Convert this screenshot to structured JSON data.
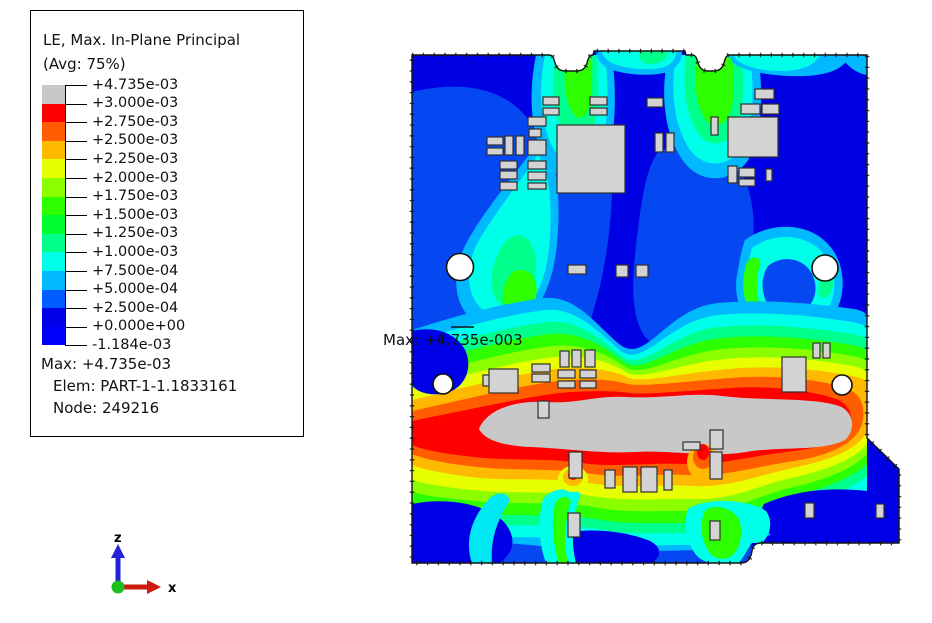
{
  "legend": {
    "title": "LE, Max. In-Plane Principal",
    "subtitle": "(Avg: 75%)",
    "bands": [
      {
        "color": "#C8C8C8",
        "label": "+4.735e-03"
      },
      {
        "color": "#FF0000",
        "label": "+3.000e-03"
      },
      {
        "color": "#FF5D00",
        "label": "+2.750e-03"
      },
      {
        "color": "#FFB900",
        "label": "+2.500e-03"
      },
      {
        "color": "#E8FF00",
        "label": "+2.250e-03"
      },
      {
        "color": "#8BFF00",
        "label": "+2.000e-03"
      },
      {
        "color": "#2EFF00",
        "label": "+1.750e-03"
      },
      {
        "color": "#00FF2E",
        "label": "+1.500e-03"
      },
      {
        "color": "#00FF8B",
        "label": "+1.250e-03"
      },
      {
        "color": "#00FFE8",
        "label": "+1.000e-03"
      },
      {
        "color": "#00B9FF",
        "label": "+7.500e-04"
      },
      {
        "color": "#005DFF",
        "label": "+5.000e-04"
      },
      {
        "color": "#0000E8",
        "label": "+2.500e-04"
      },
      {
        "color": "#0000FF",
        "label": "+0.000e+00"
      }
    ],
    "min_label": "-1.184e-03",
    "max_line": "Max: +4.735e-03",
    "elem_line": "Elem: PART-1-1.1833161",
    "node_line": "Node: 249216"
  },
  "annotation": {
    "max_label": "Max: +4.735e-003"
  },
  "triad": {
    "vertical_axis": "z",
    "horizontal_axis": "x",
    "z_color": "#2222D6",
    "x_color": "#CC1A0E",
    "origin_color": "#1FBE1F"
  },
  "plot": {
    "component_fill": "#D3D3D3",
    "component_stroke": "#2F2F2F",
    "components": [
      [
        543,
        97,
        16,
        8
      ],
      [
        543,
        108,
        16,
        7
      ],
      [
        590,
        97,
        17,
        8
      ],
      [
        590,
        108,
        17,
        7
      ],
      [
        647,
        98,
        16,
        9
      ],
      [
        755,
        89,
        19,
        10
      ],
      [
        741,
        104,
        19,
        10
      ],
      [
        762,
        104,
        17,
        10
      ],
      [
        711,
        117,
        7,
        18
      ],
      [
        487,
        137,
        16,
        8
      ],
      [
        487,
        148,
        16,
        7
      ],
      [
        505,
        136,
        8,
        19
      ],
      [
        516,
        136,
        8,
        19
      ],
      [
        528,
        117,
        18,
        9
      ],
      [
        529,
        129,
        12,
        8
      ],
      [
        528,
        140,
        18,
        15
      ],
      [
        557,
        125,
        68,
        68
      ],
      [
        500,
        161,
        17,
        8
      ],
      [
        500,
        171,
        17,
        8
      ],
      [
        500,
        182,
        17,
        8
      ],
      [
        528,
        161,
        18,
        8
      ],
      [
        528,
        172,
        18,
        8
      ],
      [
        528,
        183,
        18,
        6
      ],
      [
        728,
        117,
        50,
        40
      ],
      [
        655,
        133,
        8,
        19
      ],
      [
        666,
        133,
        8,
        19
      ],
      [
        728,
        166,
        9,
        17
      ],
      [
        739,
        168,
        16,
        9
      ],
      [
        739,
        179,
        16,
        7
      ],
      [
        766,
        169,
        6,
        12
      ],
      [
        568,
        265,
        18,
        9
      ],
      [
        616,
        265,
        12,
        12
      ],
      [
        636,
        265,
        12,
        12
      ],
      [
        483,
        375,
        7,
        11
      ],
      [
        489,
        369,
        29,
        24
      ],
      [
        532,
        364,
        18,
        8
      ],
      [
        532,
        374,
        18,
        8
      ],
      [
        560,
        351,
        9,
        16
      ],
      [
        572,
        350,
        9,
        17
      ],
      [
        585,
        350,
        10,
        17
      ],
      [
        558,
        370,
        17,
        8
      ],
      [
        580,
        370,
        16,
        8
      ],
      [
        558,
        381,
        17,
        7
      ],
      [
        580,
        381,
        16,
        7
      ],
      [
        538,
        401,
        11,
        17
      ],
      [
        569,
        452,
        13,
        26
      ],
      [
        605,
        470,
        10,
        18
      ],
      [
        623,
        467,
        14,
        25
      ],
      [
        641,
        467,
        16,
        25
      ],
      [
        664,
        470,
        8,
        20
      ],
      [
        683,
        442,
        17,
        8
      ],
      [
        710,
        430,
        13,
        19
      ],
      [
        710,
        452,
        12,
        27
      ],
      [
        782,
        357,
        24,
        35
      ],
      [
        813,
        343,
        7,
        15
      ],
      [
        823,
        343,
        7,
        15
      ],
      [
        568,
        513,
        12,
        24
      ],
      [
        710,
        521,
        10,
        19
      ],
      [
        805,
        503,
        9,
        15
      ],
      [
        876,
        504,
        8,
        14
      ]
    ],
    "holes": [
      [
        460,
        267,
        13.5
      ],
      [
        825,
        268,
        13
      ],
      [
        443,
        384,
        10
      ],
      [
        842,
        385,
        10
      ]
    ]
  }
}
